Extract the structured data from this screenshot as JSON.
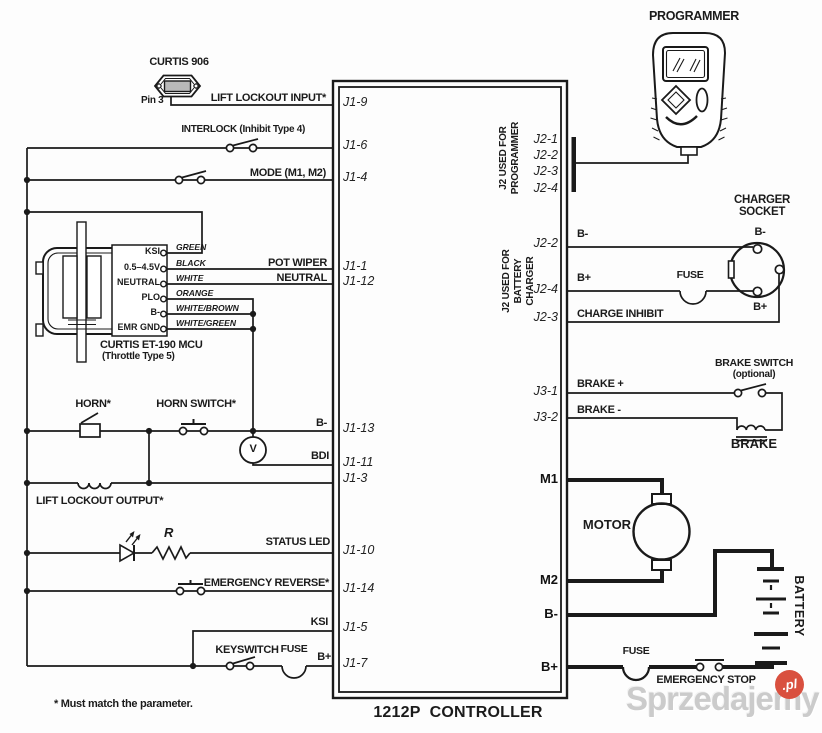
{
  "page": {
    "title": "1212P  CONTROLLER",
    "footnote": "* Must match the parameter."
  },
  "curtis906": {
    "title": "CURTIS 906",
    "pin": "Pin 3"
  },
  "throttle": {
    "title": "CURTIS ET-190 MCU",
    "subtitle": "(Throttle Type 5)",
    "pins": [
      "KSI",
      "0.5–4.5V",
      "NEUTRAL",
      "PLO",
      "B-",
      "EMR GND"
    ],
    "colors": [
      "GREEN",
      "BLACK",
      "WHITE",
      "ORANGE",
      "WHITE/BROWN",
      "WHITE/GREEN"
    ]
  },
  "left": {
    "lift_lockout_input": "LIFT LOCKOUT INPUT*",
    "interlock": "INTERLOCK (Inhibit Type 4)",
    "mode": "MODE (M1, M2)",
    "pot_wiper": "POT WIPER",
    "neutral": "NEUTRAL",
    "b_minus": "B-",
    "bdi": "BDI",
    "volt": "V",
    "horn": "HORN*",
    "horn_switch": "HORN SWITCH*",
    "lift_lockout_output": "LIFT LOCKOUT OUTPUT*",
    "status_led": "STATUS LED",
    "resistor": "R",
    "emergency_reverse": "EMERGENCY REVERSE*",
    "ksi": "KSI",
    "keyswitch": "KEYSWITCH",
    "fuse": "FUSE",
    "b_plus": "B+"
  },
  "j1": [
    "J1-9",
    "J1-6",
    "J1-4",
    "J1-1",
    "J1-12",
    "J1-13",
    "J1-11",
    "J1-3",
    "J1-10",
    "J1-14",
    "J1-5",
    "J1-7"
  ],
  "programmer": {
    "title": "PROGRAMMER",
    "group_label": "J2 USED FOR\nPROGRAMMER",
    "pins": [
      "J2-1",
      "J2-2",
      "J2-3",
      "J2-4"
    ]
  },
  "charger": {
    "group_label": "J2 USED FOR\nBATTERY CHARGER",
    "pins": [
      "J2-2",
      "J2-4",
      "J2-3"
    ],
    "b_minus": "B-",
    "b_plus": "B+",
    "fuse": "FUSE",
    "charge_inhibit": "CHARGE INHIBIT",
    "socket_title": "CHARGER\nSOCKET",
    "socket_b_minus": "B-",
    "socket_b_plus": "B+"
  },
  "brake": {
    "pins": [
      "J3-1",
      "J3-2"
    ],
    "plus": "BRAKE +",
    "minus": "BRAKE -",
    "switch_title": "BRAKE SWITCH",
    "switch_note": "(optional)",
    "label": "BRAKE"
  },
  "power": {
    "m1": "M1",
    "m2": "M2",
    "b_minus": "B-",
    "b_plus": "B+",
    "motor": "MOTOR",
    "battery": "BATTERY",
    "fuse": "FUSE",
    "emergency_stop": "EMERGENCY STOP"
  },
  "watermark": {
    "name": "Sprzedajemy",
    "tld": ".pl",
    "accent": "#d9503f"
  }
}
